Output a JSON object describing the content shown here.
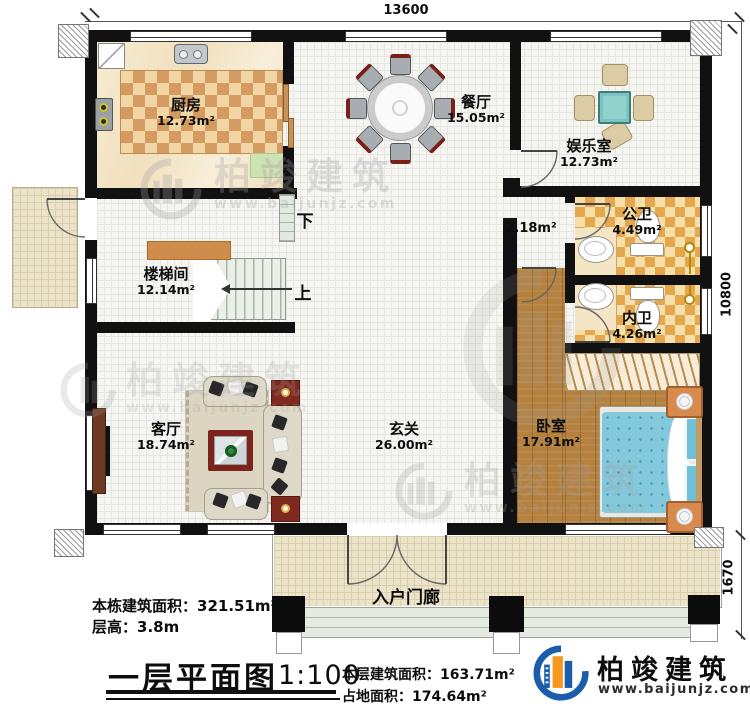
{
  "dimensions": {
    "width_top": "13600",
    "height_right": "10800",
    "porch_depth": "1670"
  },
  "rooms": {
    "kitchen": {
      "name": "厨房",
      "area": "12.73m²"
    },
    "dining": {
      "name": "餐厅",
      "area": "15.05m²"
    },
    "entertainment": {
      "name": "娱乐室",
      "area": "12.73m²"
    },
    "public_bath": {
      "name": "公卫",
      "area": "4.49m²"
    },
    "private_bath": {
      "name": "内卫",
      "area": "4.26m²"
    },
    "stair_hall": {
      "name": "楼梯间",
      "area": "12.14m²"
    },
    "living": {
      "name": "客厅",
      "area": "18.74m²"
    },
    "foyer": {
      "name": "玄关",
      "area": "26.00m²"
    },
    "bedroom": {
      "name": "卧室",
      "area": "17.91m²"
    },
    "porch": {
      "name": "入户门廊"
    },
    "corridor": {
      "area": "2.18m²"
    }
  },
  "stairs": {
    "down_label": "下",
    "up_label": "上"
  },
  "notes": {
    "building_area_label": "本栋建筑面积：",
    "building_area_value": "321.51m²",
    "floor_height_label": "层高：",
    "floor_height_value": "3.8m",
    "title": "一层平面图",
    "scale": "1:100",
    "floor_area_label": "本层建筑面积：",
    "floor_area_value": "163.71m²",
    "footprint_label": "占地面积：",
    "footprint_value": "174.64m²"
  },
  "brand": {
    "name": "柏竣建筑",
    "website": "www.baijunjz.com"
  },
  "watermark": {
    "name": "柏竣建筑",
    "website": "www.baijunjz.com"
  },
  "colors": {
    "wall": "#111111",
    "brand_blue": "#1a5dab",
    "brand_orange": "#f6981e",
    "bed_blue": "#84c8db",
    "wood_floor": "#b5813f",
    "kitchen_checker": "#d59a60",
    "bath_checker": "#e4a74e",
    "porch_floor": "#ece3cb",
    "game_table_teal": "#92d2cd"
  }
}
